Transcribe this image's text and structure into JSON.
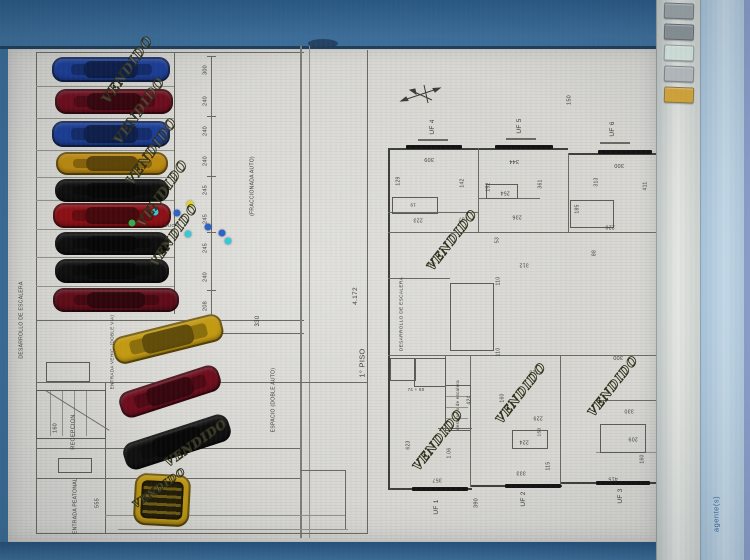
{
  "screen": {
    "background": "#3a6d98",
    "top_band_color": "#2f6490",
    "paper_color": "#d9d8d3",
    "accent_line_color": "#6a6a62"
  },
  "side_panel": {
    "tab_text": "agente(s)",
    "icons": [
      {
        "name": "tool-icon",
        "color": "#9fa8ab"
      },
      {
        "name": "tool-icon",
        "color": "#8e979c"
      },
      {
        "name": "printer-icon",
        "color": "#dcebe5"
      },
      {
        "name": "grid-icon",
        "color": "#bcc1c4"
      },
      {
        "name": "folder-icon",
        "color": "#d9a93c"
      }
    ]
  },
  "drawing": {
    "watermark_text": "VENDIDO",
    "floor_left_label": "1° PISO",
    "floor_right_label": "2° PISO",
    "area_value": "4.172",
    "annotations": [
      {
        "t": "300",
        "x": 206,
        "y": 70,
        "r": -90,
        "s": 5.5
      },
      {
        "t": "240",
        "x": 206,
        "y": 101,
        "r": -90,
        "s": 5.5
      },
      {
        "t": "240",
        "x": 206,
        "y": 131,
        "r": -90,
        "s": 5.5
      },
      {
        "t": "240",
        "x": 206,
        "y": 161,
        "r": -90,
        "s": 5.5
      },
      {
        "t": "245",
        "x": 206,
        "y": 190,
        "r": -90,
        "s": 5.5
      },
      {
        "t": "245",
        "x": 206,
        "y": 219,
        "r": -90,
        "s": 5.5
      },
      {
        "t": "245",
        "x": 206,
        "y": 248,
        "r": -90,
        "s": 5.5
      },
      {
        "t": "240",
        "x": 206,
        "y": 277,
        "r": -90,
        "s": 5.5
      },
      {
        "t": "208",
        "x": 206,
        "y": 306,
        "r": -90,
        "s": 5.5
      },
      {
        "t": "DESARROLLO DE ESCALERA",
        "x": 22,
        "y": 320,
        "r": -90,
        "s": 5
      },
      {
        "t": "ENTRADA VEHIC. (DOBLE VIA)",
        "x": 113,
        "y": 352,
        "r": -90,
        "s": 4.6
      },
      {
        "t": "RECEPCION",
        "x": 74,
        "y": 432,
        "r": -90,
        "s": 5.5
      },
      {
        "t": "160",
        "x": 56,
        "y": 428,
        "r": -90,
        "s": 5.5
      },
      {
        "t": "ENTRADA PEATONAL",
        "x": 76,
        "y": 506,
        "r": -90,
        "s": 5
      },
      {
        "t": "555",
        "x": 98,
        "y": 503,
        "r": -90,
        "s": 5.5
      },
      {
        "t": "(FRACCIONADA AUTO)",
        "x": 253,
        "y": 186,
        "r": -90,
        "s": 5
      },
      {
        "t": "ESPACIO (DOBLE AUTO)",
        "x": 274,
        "y": 400,
        "r": -90,
        "s": 5
      },
      {
        "t": "330",
        "x": 258,
        "y": 321,
        "r": -90,
        "s": 6
      },
      {
        "t": "DUO 1",
        "x": 172,
        "y": 226,
        "r": 0,
        "s": 4.5
      },
      {
        "t": "1° PISO",
        "x": 362,
        "y": 363,
        "r": -90,
        "s": 7.5
      },
      {
        "t": "4.172",
        "x": 356,
        "y": 296,
        "r": -90,
        "s": 6.5
      },
      {
        "t": "2° PISO",
        "x": 673,
        "y": 397,
        "r": -90,
        "s": 7.5
      },
      {
        "t": "4.172",
        "x": 681,
        "y": 296,
        "r": -90,
        "s": 6.5
      },
      {
        "t": "UF 4",
        "x": 433,
        "y": 127,
        "r": -90,
        "s": 6.5
      },
      {
        "t": "UF 5",
        "x": 520,
        "y": 126,
        "r": -90,
        "s": 6.5
      },
      {
        "t": "UF 6",
        "x": 613,
        "y": 129,
        "r": -90,
        "s": 6.5
      },
      {
        "t": "150",
        "x": 570,
        "y": 100,
        "r": -90,
        "s": 5.5
      },
      {
        "t": "309",
        "x": 429,
        "y": 158,
        "r": 180,
        "s": 5.5
      },
      {
        "t": "344",
        "x": 514,
        "y": 160,
        "r": 180,
        "s": 5.5
      },
      {
        "t": "300",
        "x": 619,
        "y": 164,
        "r": 180,
        "s": 5.5
      },
      {
        "t": "129",
        "x": 399,
        "y": 181,
        "r": -90,
        "s": 5
      },
      {
        "t": "142",
        "x": 463,
        "y": 183,
        "r": -90,
        "s": 5
      },
      {
        "t": "152",
        "x": 489,
        "y": 187,
        "r": -90,
        "s": 5
      },
      {
        "t": "361",
        "x": 541,
        "y": 184,
        "r": -90,
        "s": 5
      },
      {
        "t": "19",
        "x": 413,
        "y": 204,
        "r": 180,
        "s": 4.5
      },
      {
        "t": "254",
        "x": 505,
        "y": 192,
        "r": 180,
        "s": 5.2
      },
      {
        "t": "236",
        "x": 517,
        "y": 216,
        "r": 180,
        "s": 5.2
      },
      {
        "t": "107",
        "x": 463,
        "y": 218,
        "r": 180,
        "s": 5.2
      },
      {
        "t": "223",
        "x": 418,
        "y": 219,
        "r": 180,
        "s": 5.2
      },
      {
        "t": "53",
        "x": 498,
        "y": 240,
        "r": -90,
        "s": 5
      },
      {
        "t": "336",
        "x": 431,
        "y": 263,
        "r": 180,
        "s": 5.2
      },
      {
        "t": "312",
        "x": 524,
        "y": 264,
        "r": 180,
        "s": 5.2
      },
      {
        "t": "313",
        "x": 597,
        "y": 182,
        "r": -90,
        "s": 5
      },
      {
        "t": "411",
        "x": 646,
        "y": 186,
        "r": -90,
        "s": 5
      },
      {
        "t": "185",
        "x": 578,
        "y": 209,
        "r": -90,
        "s": 5
      },
      {
        "t": "220",
        "x": 610,
        "y": 226,
        "r": 180,
        "s": 5.2
      },
      {
        "t": "88",
        "x": 595,
        "y": 253,
        "r": -90,
        "s": 5
      },
      {
        "t": "DESARROLLO DE ESCALERA",
        "x": 403,
        "y": 314,
        "r": -90,
        "s": 4.8
      },
      {
        "t": "110",
        "x": 499,
        "y": 281,
        "r": -90,
        "s": 5
      },
      {
        "t": "110",
        "x": 499,
        "y": 352,
        "r": -90,
        "s": 5
      },
      {
        "t": "desarrollo de escalera",
        "x": 458,
        "y": 405,
        "r": -90,
        "s": 4.4
      },
      {
        "t": "424",
        "x": 470,
        "y": 400,
        "r": -90,
        "s": 5
      },
      {
        "t": "74 + 60",
        "x": 416,
        "y": 390,
        "r": 0,
        "s": 4.4
      },
      {
        "t": "160",
        "x": 503,
        "y": 398,
        "r": -90,
        "s": 5
      },
      {
        "t": "316",
        "x": 534,
        "y": 371,
        "r": 180,
        "s": 5.2
      },
      {
        "t": "1.06",
        "x": 450,
        "y": 453,
        "r": -90,
        "s": 5
      },
      {
        "t": "229",
        "x": 538,
        "y": 417,
        "r": 180,
        "s": 5.2
      },
      {
        "t": "150",
        "x": 541,
        "y": 432,
        "r": -90,
        "s": 4.8
      },
      {
        "t": "224",
        "x": 524,
        "y": 441,
        "r": 180,
        "s": 5.2
      },
      {
        "t": "333",
        "x": 521,
        "y": 472,
        "r": 180,
        "s": 5.2
      },
      {
        "t": "115",
        "x": 549,
        "y": 466,
        "r": -90,
        "s": 5
      },
      {
        "t": "357",
        "x": 437,
        "y": 479,
        "r": 180,
        "s": 5.2
      },
      {
        "t": "623",
        "x": 409,
        "y": 445,
        "r": -90,
        "s": 5
      },
      {
        "t": "UF 1",
        "x": 437,
        "y": 507,
        "r": -90,
        "s": 6.5
      },
      {
        "t": "390",
        "x": 477,
        "y": 503,
        "r": -90,
        "s": 5.5
      },
      {
        "t": "UF 2",
        "x": 524,
        "y": 499,
        "r": -90,
        "s": 6.5
      },
      {
        "t": "UF 3",
        "x": 621,
        "y": 496,
        "r": -90,
        "s": 6.5
      },
      {
        "t": "300",
        "x": 618,
        "y": 356,
        "r": 180,
        "s": 5.5
      },
      {
        "t": "330",
        "x": 629,
        "y": 410,
        "r": 180,
        "s": 5.2
      },
      {
        "t": "209",
        "x": 633,
        "y": 438,
        "r": 180,
        "s": 5.2
      },
      {
        "t": "160",
        "x": 643,
        "y": 459,
        "r": -90,
        "s": 5
      },
      {
        "t": "415",
        "x": 613,
        "y": 478,
        "r": 180,
        "s": 5.2
      }
    ],
    "watermarks": [
      {
        "x": 128,
        "y": 70,
        "r": -55,
        "s": 13
      },
      {
        "x": 140,
        "y": 111,
        "r": -55,
        "s": 13
      },
      {
        "x": 152,
        "y": 152,
        "r": -55,
        "s": 13
      },
      {
        "x": 163,
        "y": 194,
        "r": -55,
        "s": 13
      },
      {
        "x": 174,
        "y": 235,
        "r": -55,
        "s": 12
      },
      {
        "x": 196,
        "y": 443,
        "r": -35,
        "s": 12
      },
      {
        "x": 160,
        "y": 489,
        "r": -35,
        "s": 10
      },
      {
        "x": 452,
        "y": 240,
        "r": -52,
        "s": 12
      },
      {
        "x": 438,
        "y": 440,
        "r": -52,
        "s": 12
      },
      {
        "x": 521,
        "y": 393,
        "r": -52,
        "s": 12
      },
      {
        "x": 613,
        "y": 386,
        "r": -52,
        "s": 12
      }
    ],
    "cars": [
      {
        "x": 52,
        "y": 57,
        "w": 118,
        "h": 25,
        "r": 0,
        "c": "#1c3e97"
      },
      {
        "x": 55,
        "y": 89,
        "w": 118,
        "h": 25,
        "r": 0,
        "c": "#6e0d1d"
      },
      {
        "x": 52,
        "y": 121,
        "w": 118,
        "h": 26,
        "r": 0,
        "c": "#1c3e97"
      },
      {
        "x": 56,
        "y": 152,
        "w": 112,
        "h": 23,
        "r": 0,
        "c": "#bc8a10"
      },
      {
        "x": 55,
        "y": 179,
        "w": 114,
        "h": 23,
        "r": 0,
        "c": "#0f0f0f"
      },
      {
        "x": 53,
        "y": 203,
        "w": 118,
        "h": 25,
        "r": 0,
        "c": "#8c1016"
      },
      {
        "x": 55,
        "y": 232,
        "w": 114,
        "h": 23,
        "r": 0,
        "c": "#0f0f0f"
      },
      {
        "x": 55,
        "y": 259,
        "w": 114,
        "h": 24,
        "r": 0,
        "c": "#0f0f0f"
      },
      {
        "x": 53,
        "y": 288,
        "w": 126,
        "h": 24,
        "r": 0,
        "c": "#5f0c18"
      },
      {
        "x": 112,
        "y": 325,
        "w": 112,
        "h": 28,
        "r": -14,
        "c": "#c39a12"
      },
      {
        "x": 118,
        "y": 378,
        "w": 104,
        "h": 27,
        "r": -18,
        "c": "#6e0d1d"
      },
      {
        "x": 122,
        "y": 428,
        "w": 110,
        "h": 28,
        "r": -18,
        "c": "#101010"
      },
      {
        "x": 134,
        "y": 474,
        "w": 56,
        "h": 52,
        "r": 3,
        "c": "#bf9710",
        "open": true
      }
    ],
    "markers": [
      {
        "x": 190,
        "y": 204,
        "c": "#ddd42f"
      },
      {
        "x": 177,
        "y": 213,
        "c": "#2d62c8"
      },
      {
        "x": 155,
        "y": 212,
        "c": "#38c8d8"
      },
      {
        "x": 132,
        "y": 223,
        "c": "#3aa94e"
      },
      {
        "x": 208,
        "y": 227,
        "c": "#2d62c8"
      },
      {
        "x": 188,
        "y": 234,
        "c": "#38c8d8"
      },
      {
        "x": 222,
        "y": 233,
        "c": "#2d62c8"
      },
      {
        "x": 228,
        "y": 241,
        "c": "#38c8d8"
      }
    ]
  }
}
